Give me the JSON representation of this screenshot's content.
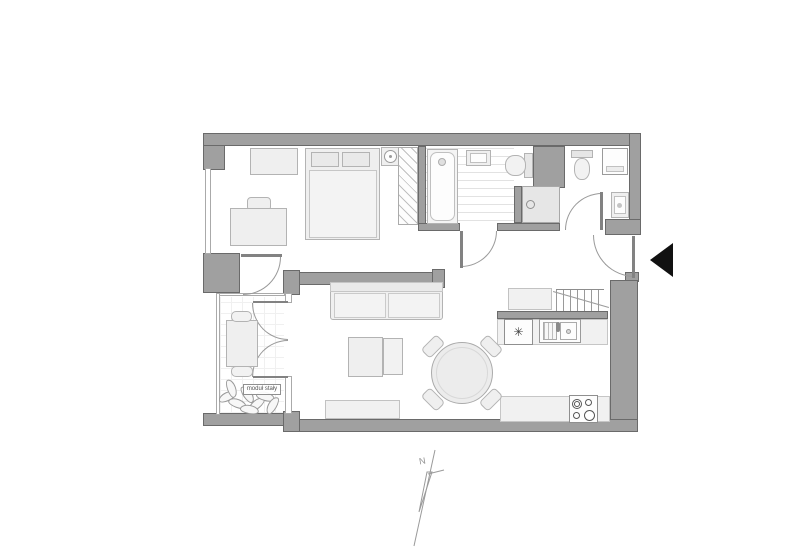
{
  "scene": {
    "type": "apartment-floor-plan",
    "balcony_planter_label": "moduł stały",
    "north_label": "N",
    "fridge_symbol": "✳",
    "colors": {
      "background": "#ffffff",
      "wall_fill": "#a0a0a0",
      "wall_edge": "#6a6a6a",
      "furniture_fill": "#efefef",
      "furniture_edge": "#b3b3b3",
      "door_line": "#999999",
      "entrance_marker": "#111111"
    },
    "rooms": [
      {
        "name": "bedroom",
        "items": [
          "double-bed",
          "pillows",
          "duvet",
          "wardrobe-hatch",
          "desk",
          "desk-chair",
          "dresser",
          "nightstand-clock",
          "window"
        ]
      },
      {
        "name": "bathroom",
        "items": [
          "bathtub",
          "washbasin",
          "toilet",
          "shower-tray",
          "floor-tiles",
          "door"
        ]
      },
      {
        "name": "wc-laundry",
        "items": [
          "toilet",
          "washing-machine",
          "washbasin",
          "door"
        ]
      },
      {
        "name": "hallway",
        "items": [
          "shoe-bench",
          "coat-rack",
          "entrance-door"
        ]
      },
      {
        "name": "kitchen",
        "items": [
          "fridge",
          "sink-unit",
          "worktop",
          "cooktop-4-burners",
          "half-wall"
        ]
      },
      {
        "name": "living-dining",
        "items": [
          "sofa",
          "armchair",
          "ottoman",
          "tv-bench",
          "round-dining-table",
          "dining-chairs-x4",
          "french-doors"
        ]
      },
      {
        "name": "balcony",
        "items": [
          "bistro-table",
          "chairs-x2",
          "planter",
          "glazing"
        ]
      }
    ],
    "markers": [
      "entrance-arrow",
      "north-arrow"
    ]
  }
}
